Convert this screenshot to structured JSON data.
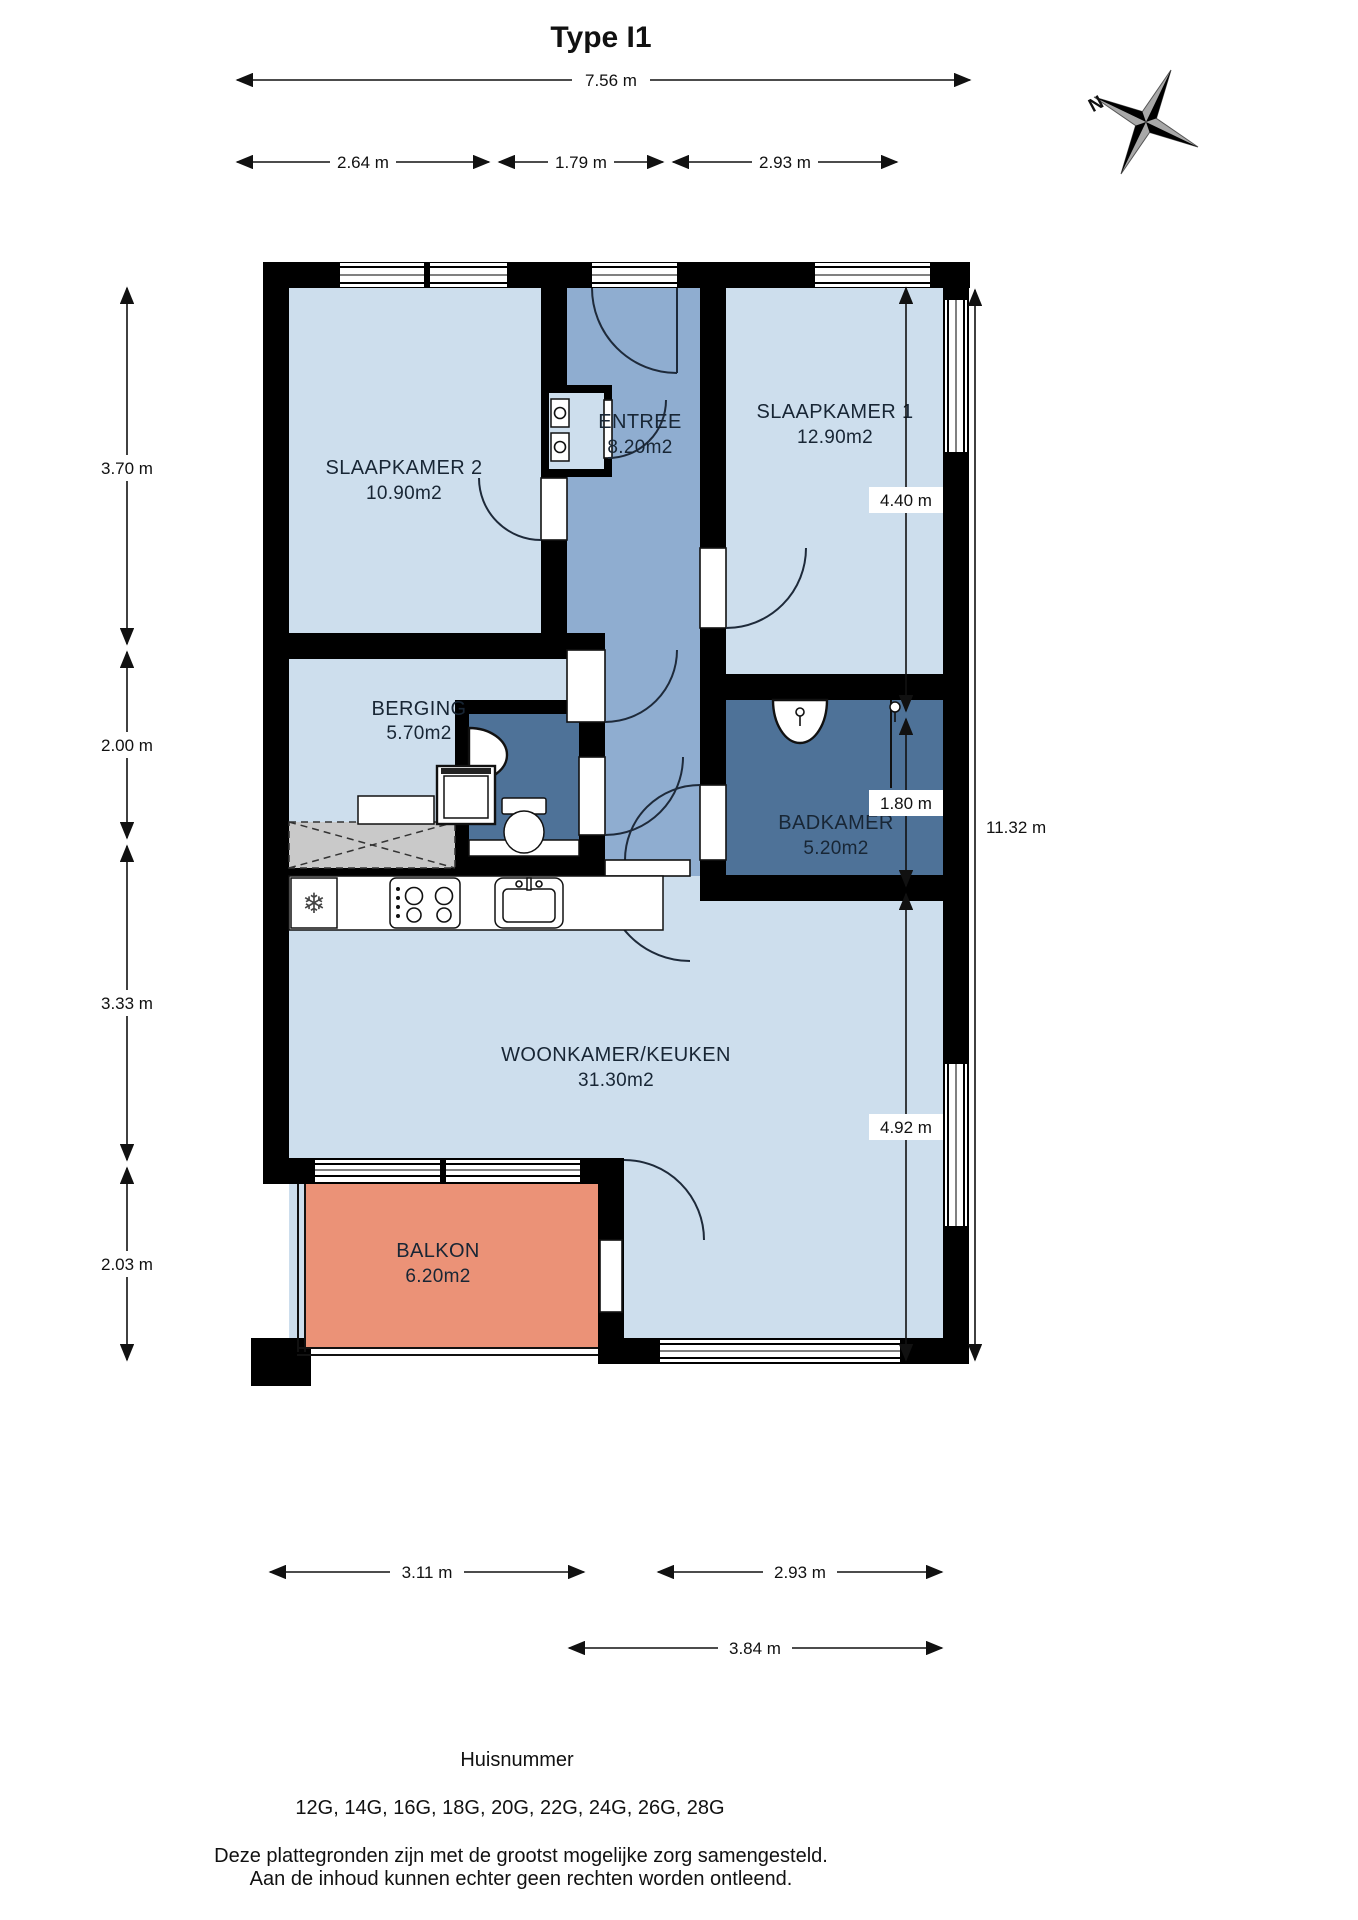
{
  "title": "Type I1",
  "compass": {
    "north_label": "N"
  },
  "rooms": [
    {
      "id": "slaapkamer2",
      "name": "SLAAPKAMER 2",
      "area": "10.90m2"
    },
    {
      "id": "entree",
      "name": "ENTREE",
      "area": "8.20m2"
    },
    {
      "id": "slaapkamer1",
      "name": "SLAAPKAMER 1",
      "area": "12.90m2"
    },
    {
      "id": "berging",
      "name": "BERGING",
      "area": "5.70m2"
    },
    {
      "id": "badkamer",
      "name": "BADKAMER",
      "area": "5.20m2"
    },
    {
      "id": "woonkamer",
      "name": "WOONKAMER/KEUKEN",
      "area": "31.30m2"
    },
    {
      "id": "balkon",
      "name": "BALKON",
      "area": "6.20m2"
    }
  ],
  "dimensions": {
    "top_total": "7.56 m",
    "top_segments": [
      "2.64 m",
      "1.79 m",
      "2.93 m"
    ],
    "left": [
      "3.70 m",
      "2.00 m",
      "3.33 m",
      "2.03 m"
    ],
    "right": [
      "4.40 m",
      "1.80 m",
      "4.92 m"
    ],
    "right_total": "11.32 m",
    "bottom_row1": [
      "3.11 m",
      "2.93 m"
    ],
    "bottom_row2": "3.84 m"
  },
  "footer": {
    "huisnummer_label": "Huisnummer",
    "huisnummers": "12G, 14G, 16G, 18G, 20G, 22G, 24G, 26G, 28G",
    "disclaimer_line1": "Deze plattegronden zijn met de grootst mogelijke zorg samengesteld.",
    "disclaimer_line2": "Aan de inhoud kunnen echter geen rechten worden ontleend."
  },
  "icons": {
    "freezer": "❄"
  },
  "colors": {
    "room-light": "#cddeed",
    "room-mid": "#8fadd0",
    "room-dark": "#4e7298",
    "balcony": "#eb9277",
    "wall": "#000000",
    "hatch": "#c9c9c9",
    "ink": "#111111",
    "label": "#182635"
  }
}
